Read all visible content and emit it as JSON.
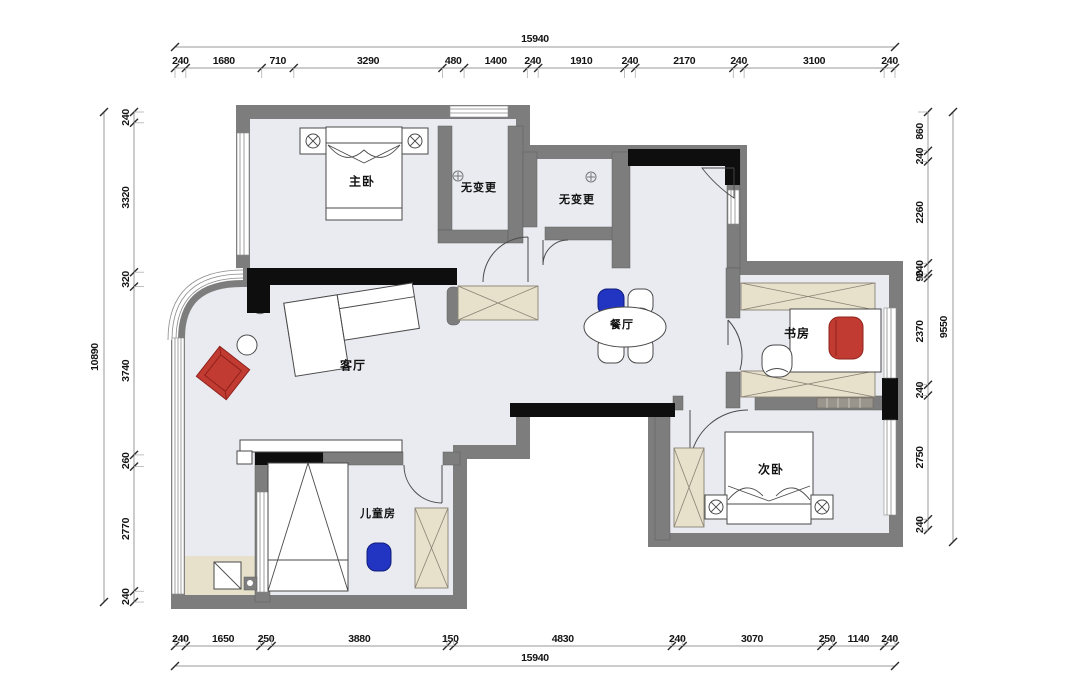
{
  "drawing": {
    "type": "residential floor plan"
  },
  "rooms": [
    {
      "id": "master-bedroom",
      "label": "主卧"
    },
    {
      "id": "no-change-1",
      "label": "无变更"
    },
    {
      "id": "no-change-2",
      "label": "无变更"
    },
    {
      "id": "dining-room",
      "label": "餐厅"
    },
    {
      "id": "study",
      "label": "书房"
    },
    {
      "id": "living-room",
      "label": "客厅"
    },
    {
      "id": "kids-room",
      "label": "儿童房"
    },
    {
      "id": "second-bedroom",
      "label": "次卧"
    }
  ],
  "dimensions": {
    "top": {
      "total": "15940",
      "segments": [
        "240",
        "1680",
        "710",
        "3290",
        "480",
        "1400",
        "240",
        "1910",
        "240",
        "2170",
        "240",
        "3100",
        "240"
      ]
    },
    "bottom": {
      "total": "15940",
      "segments": [
        "240",
        "1650",
        "250",
        "3880",
        "150",
        "4830",
        "240",
        "3070",
        "250",
        "1140",
        "240"
      ]
    },
    "left": {
      "total": "10890",
      "segments": [
        "240",
        "3320",
        "320",
        "3740",
        "260",
        "2770",
        "240"
      ]
    },
    "right": {
      "total": "9550",
      "segments": [
        "860",
        "240",
        "2260",
        "240",
        "90",
        "2370",
        "240",
        "2750",
        "240"
      ]
    }
  },
  "colors": {
    "floor": "#e9ebf1",
    "wall": "#7d7d7d",
    "wall_dark": "#0e0e0e",
    "cabinet": "#e7e0cb",
    "accent_red": "#c23b32",
    "accent_blue": "#2134c2"
  }
}
